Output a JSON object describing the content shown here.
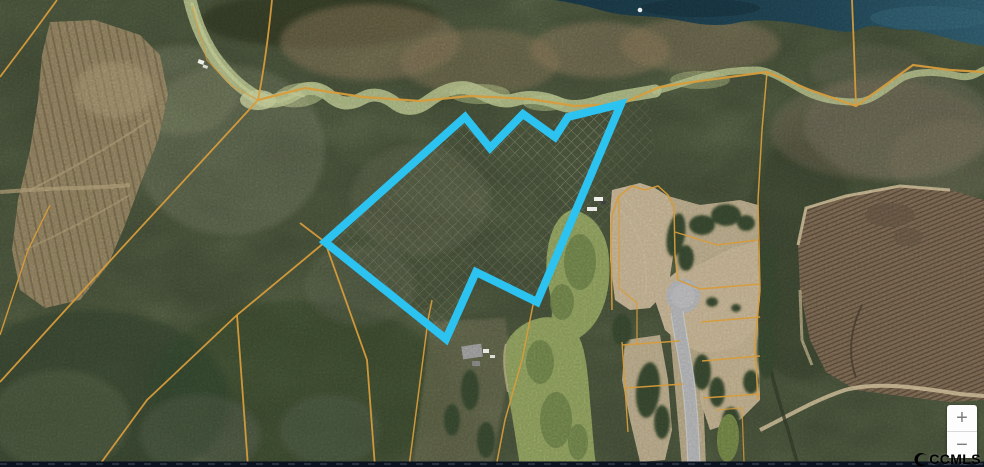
{
  "window": {
    "width": 984,
    "height": 467
  },
  "map": {
    "kind": "aerial-parcel-map",
    "colors": {
      "forest_base": "#39412e",
      "boundary": "#2cc3f1",
      "parcel_line": "#d79c3c",
      "water": "#1c3a47",
      "creek": "#a9b57f",
      "pond": "#7f9054",
      "sand": "#b5a383",
      "road": "#a3a4a6",
      "field": "#6f5e4a",
      "clearcut": "#8b7a5c",
      "bottom_bar": "#0b1220"
    },
    "subject_parcel": {
      "outline_points": "325,242 465,117 490,148 523,114 555,137 568,117 621,104 537,302 476,272 446,339",
      "stroke_width": 8
    }
  },
  "controls": {
    "zoom_in_label": "+",
    "zoom_out_label": "−"
  },
  "watermark": {
    "label": "CCMLS",
    "logo_icon": "crescent-swoosh-icon"
  }
}
